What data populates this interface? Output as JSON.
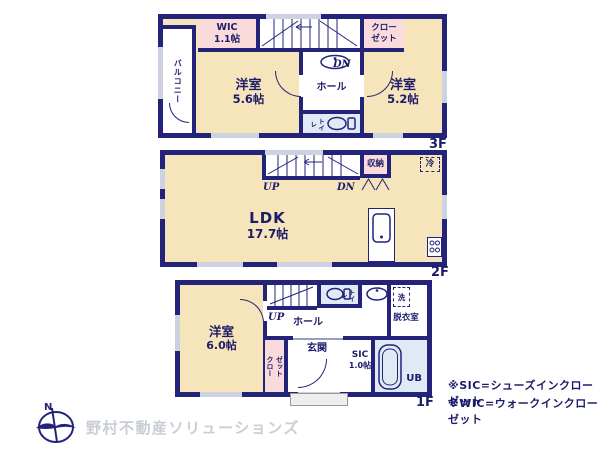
{
  "colors": {
    "wall": "#23237a",
    "cream": "#f6e4bb",
    "pink": "#f9dbdc",
    "wet": "#dfeaf5",
    "window": "#ccd2e0",
    "text": "#1c1c6a",
    "logo_text": "#c9cdd5",
    "porch": "#eeeeee"
  },
  "floor3": {
    "label": "3F",
    "balcony": "バルコニー",
    "wic_name": "WIC",
    "wic_size": "1.1帖",
    "closet_line1": "クロー",
    "closet_line2": "ゼット",
    "room_west_name": "洋室",
    "room_west_size": "5.6帖",
    "hall": "ホール",
    "dn": "DN",
    "toilet": "トイレ",
    "room_east_name": "洋室",
    "room_east_size": "5.2帖"
  },
  "floor2": {
    "label": "2F",
    "up": "UP",
    "dn": "DN",
    "storage": "収納",
    "fridge": "冷",
    "ldk_name": "LDK",
    "ldk_size": "17.7帖"
  },
  "floor1": {
    "label": "1F",
    "room_name": "洋室",
    "room_size": "6.0帖",
    "up": "UP",
    "hall": "ホール",
    "toilet": "トイレ",
    "washer": "洗",
    "dressing": "脱衣室",
    "closet_line1": "クロー",
    "closet_line2": "ゼット",
    "entrance": "玄関",
    "sic_name": "SIC",
    "sic_size": "1.0帖",
    "bath": "UB"
  },
  "notes": [
    "※SIC=シューズインクローゼット",
    "※WIC=ウォークインクローゼット"
  ],
  "logo": {
    "north": "N",
    "company": "野村不動産ソリューションズ"
  }
}
